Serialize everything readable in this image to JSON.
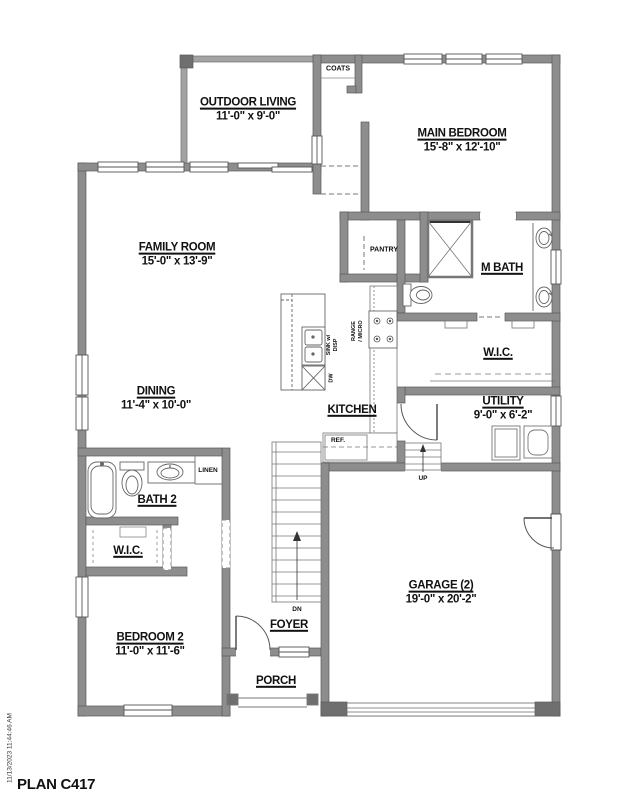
{
  "plan": {
    "title": "PLAN C417",
    "printed": "11/13/2023 11:44:46 AM"
  },
  "rooms": {
    "outdoor_living": {
      "name": "OUTDOOR LIVING",
      "dims": "11'-0\" x 9'-0\""
    },
    "main_bedroom": {
      "name": "MAIN BEDROOM",
      "dims": "15'-8\" x 12'-10\""
    },
    "family_room": {
      "name": "FAMILY ROOM",
      "dims": "15'-0\" x 13'-9\""
    },
    "dining": {
      "name": "DINING",
      "dims": "11'-4\" x 10'-0\""
    },
    "kitchen": {
      "name": "KITCHEN"
    },
    "m_bath": {
      "name": "M BATH"
    },
    "wic_main": {
      "name": "W.I.C."
    },
    "utility": {
      "name": "UTILITY",
      "dims": "9'-0\" x 6'-2\""
    },
    "bath2": {
      "name": "BATH 2"
    },
    "wic2": {
      "name": "W.I.C."
    },
    "bedroom2": {
      "name": "BEDROOM 2",
      "dims": "11'-0\" x 11'-6\""
    },
    "foyer": {
      "name": "FOYER"
    },
    "porch": {
      "name": "PORCH"
    },
    "garage": {
      "name": "GARAGE (2)",
      "dims": "19'-0\" x 20'-2\""
    }
  },
  "closets": {
    "coats": "COATS",
    "pantry": "PANTRY",
    "linen": "LINEN"
  },
  "annotations": {
    "ref": "REF.",
    "up": "UP",
    "dn": "DN",
    "dw": "DW",
    "sink_line1": "SINK w/",
    "sink_line2": "DISP",
    "range_line1": "RANGE",
    "range_line2": "/ MICRO"
  },
  "colors": {
    "wall": "#8d8d8d",
    "wall_dark": "#6f6f6f",
    "line": "#4d4d4d",
    "text": "#111111",
    "background": "#ffffff"
  }
}
